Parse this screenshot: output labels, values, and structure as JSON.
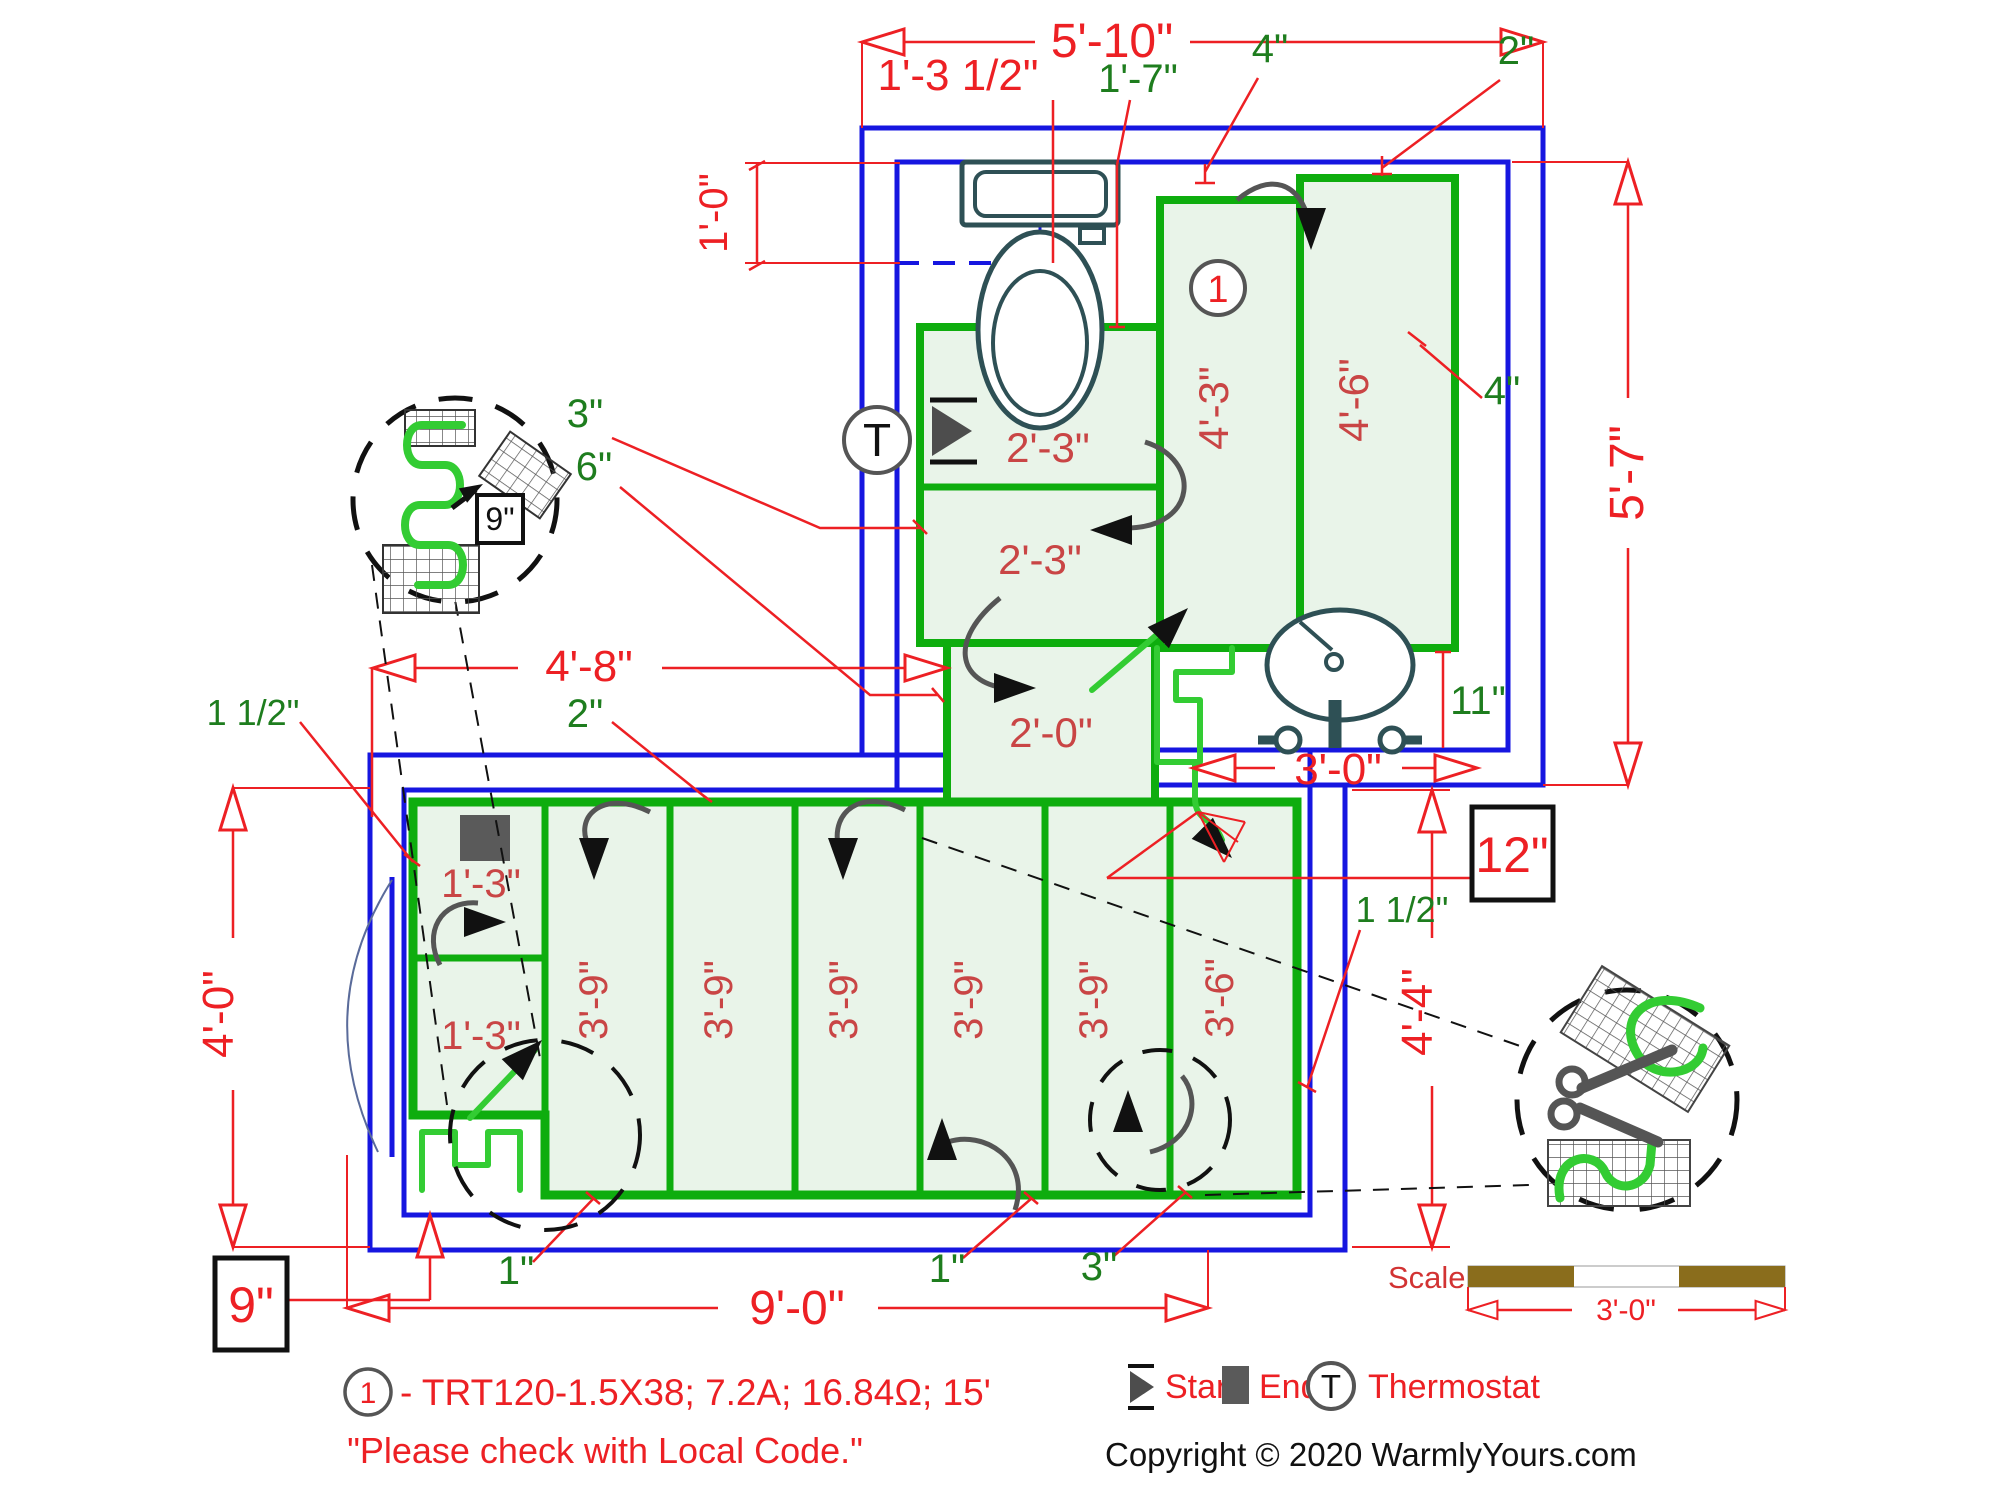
{
  "dims": {
    "top_width": "5'-10\"",
    "toilet_offset": "1'-3 1/2\"",
    "toilet_depth": "1'-0\"",
    "toilet_mat_width": "1'-7\"",
    "gap_top_a": "4\"",
    "gap_top_b": "2\"",
    "right_height": "5'-7\"",
    "gap_right": "4\"",
    "sink_gap": "11\"",
    "sink_width": "3'-0\"",
    "spacing_box_12": "12\"",
    "hall_height": "4'-4\"",
    "gap_hall": "1 1/2\"",
    "left_width": "4'-8\"",
    "gap_left_top": "2\"",
    "gap_left": "1 1/2\"",
    "gap_mid_a": "3\"",
    "gap_mid_b": "6\"",
    "room_height": "4'-0\"",
    "room_width": "9'-0\"",
    "spacing_box_9": "9\"",
    "detail_spacing_9": "9\"",
    "gap_bottom_a": "1\"",
    "gap_bottom_b": "1\"",
    "gap_bottom_c": "3\""
  },
  "mats": {
    "zone_ref": "1",
    "toilet_runs": [
      "2'-3\"",
      "2'-3\"",
      "2'-0\""
    ],
    "tall_runs": [
      "4'-3\"",
      "4'-6\""
    ],
    "left_cells": [
      "1'-3\"",
      "1'-3\""
    ],
    "floor_runs": [
      "3'-9\"",
      "3'-9\"",
      "3'-9\"",
      "3'-9\"",
      "3'-9\"",
      "3'-6\""
    ]
  },
  "legend": {
    "start": "Start",
    "end": "End",
    "thermostat": "Thermostat",
    "thermostat_symbol": "T",
    "note_ref": "1",
    "note_text": "- TRT120-1.5X38; 7.2A; 16.84Ω; 15'",
    "disclaimer": "\"Please check with Local Code.\"",
    "copyright": "Copyright © 2020 WarmlyYours.com"
  },
  "scale_bar": {
    "label": "Scale",
    "value": "3'-0\""
  },
  "colors": {
    "wall_blue": "#1616e0",
    "mat_fill": "#e9f4e9",
    "mat_border": "#0ead0e",
    "wire_green": "#33cc33",
    "dim_red": "#ed2024",
    "mat_label_red": "#c94545",
    "dim_green": "#1e7d1e",
    "fixture_slate": "#2e5055",
    "scale_brown": "#8a6d1c"
  }
}
